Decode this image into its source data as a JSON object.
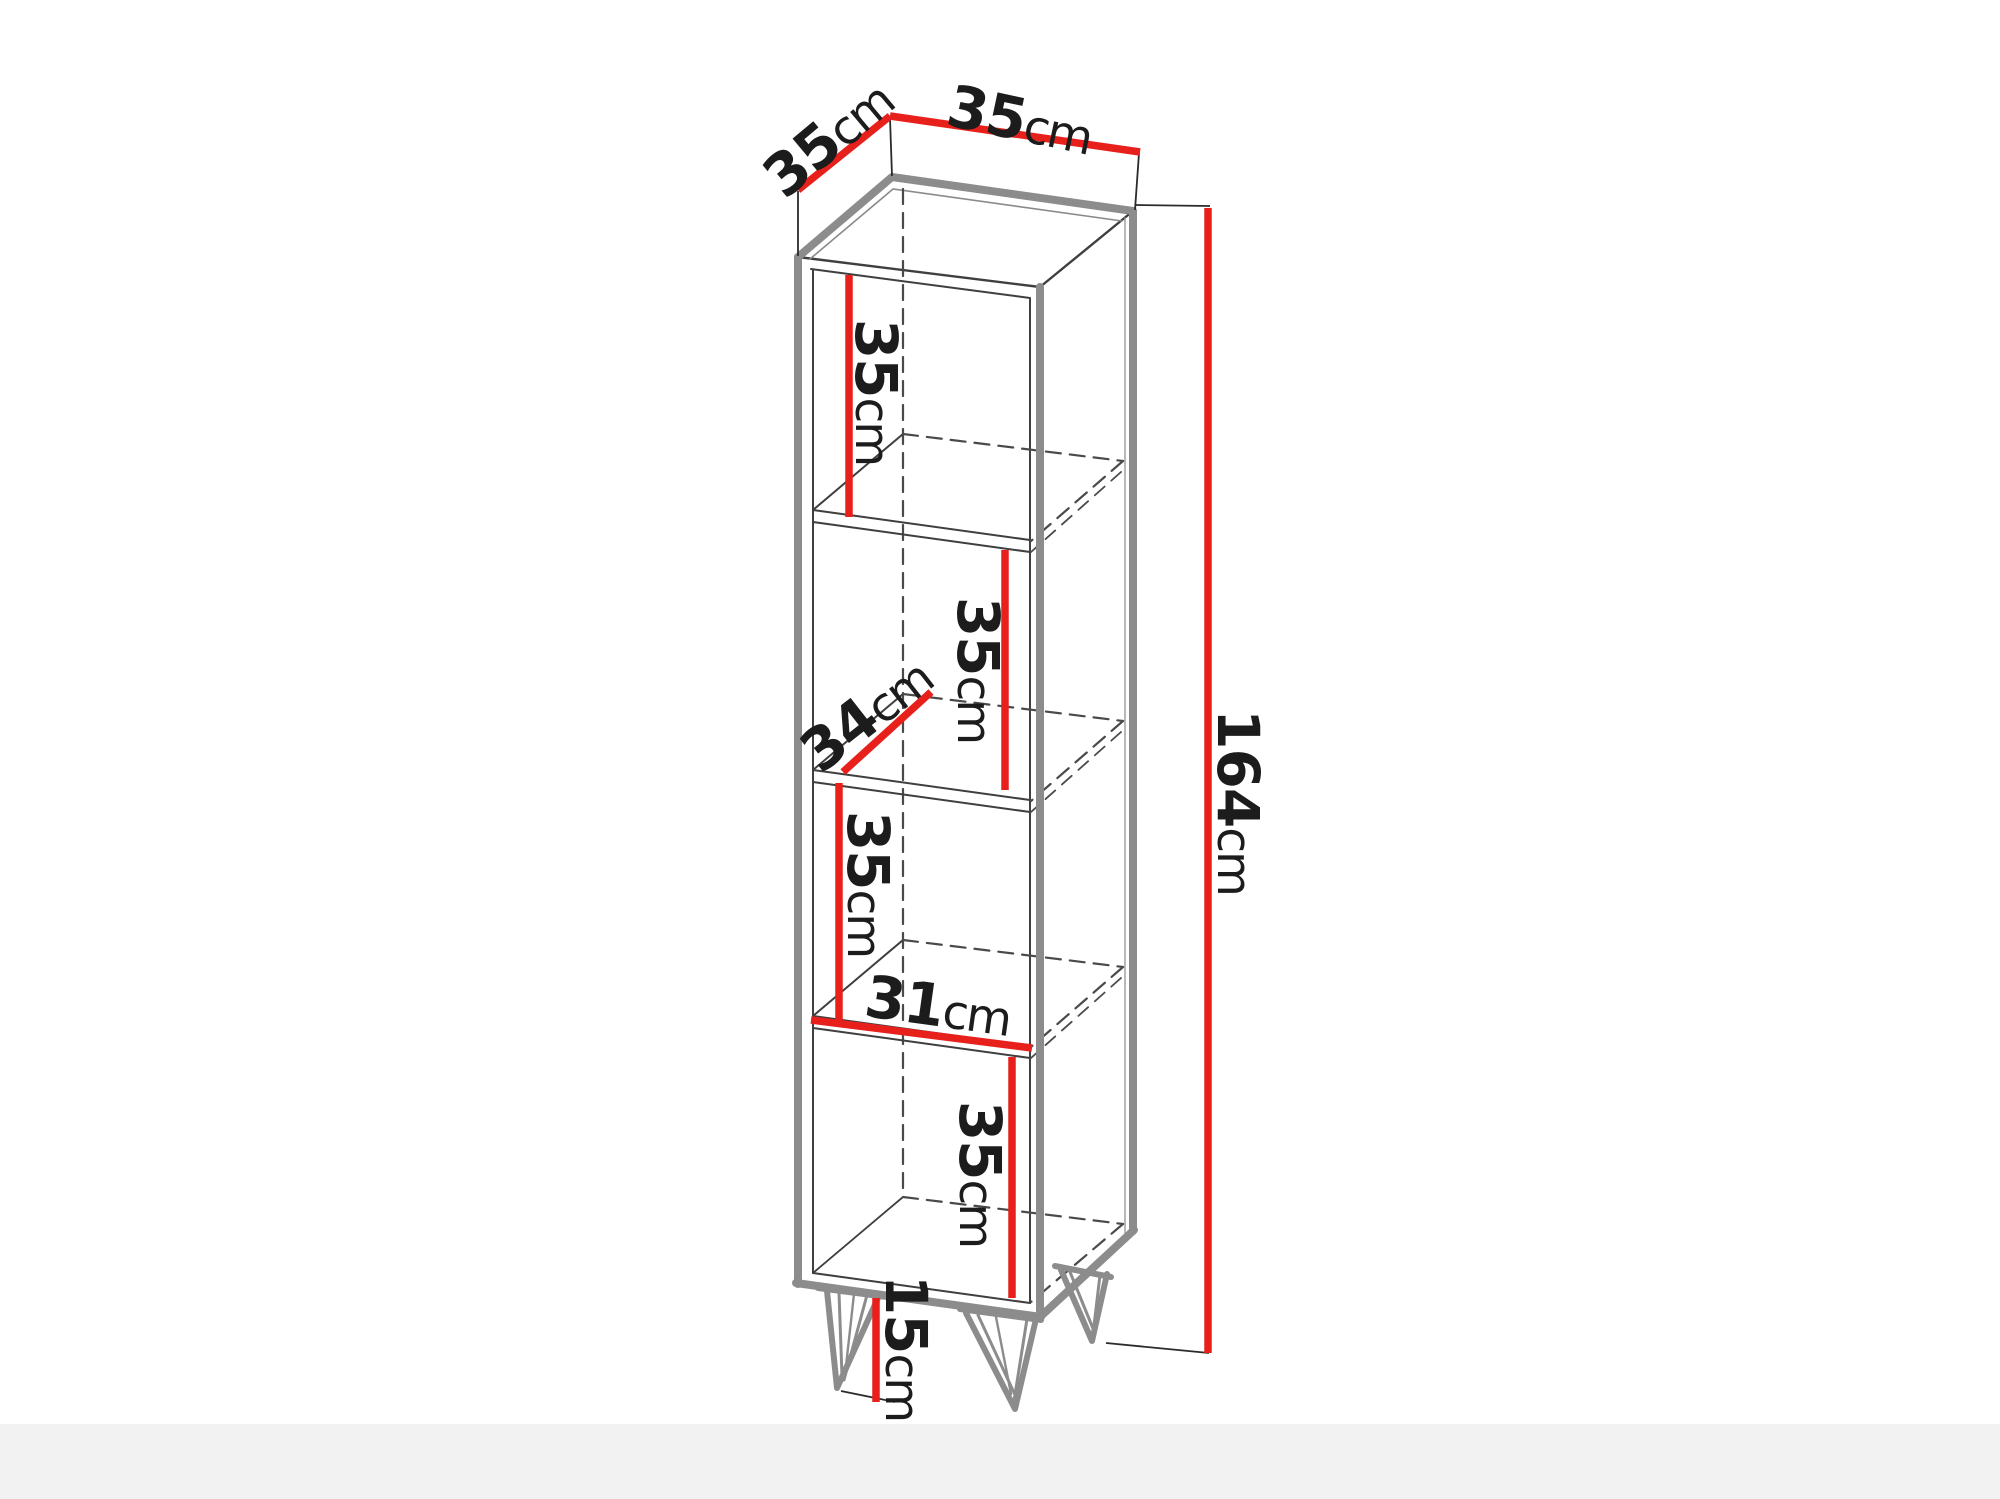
{
  "diagram": {
    "type": "furniture-dimension-drawing",
    "unit_system": "cm",
    "colors": {
      "dimension_line": "#e8201c",
      "outline_gray": "#8c8c8c",
      "line_dark": "#3f3f3f",
      "background": "#ffffff",
      "floor_band": "#f2f2f2"
    },
    "dimensions": {
      "top_depth": {
        "value": "35",
        "unit": "cm"
      },
      "top_width": {
        "value": "35",
        "unit": "cm"
      },
      "compartment_1": {
        "value": "35",
        "unit": "cm"
      },
      "compartment_2": {
        "value": "35",
        "unit": "cm"
      },
      "shelf_depth": {
        "value": "34",
        "unit": "cm"
      },
      "compartment_3": {
        "value": "35",
        "unit": "cm"
      },
      "shelf_width": {
        "value": "31",
        "unit": "cm"
      },
      "compartment_4": {
        "value": "35",
        "unit": "cm"
      },
      "leg_height": {
        "value": "15",
        "unit": "cm"
      },
      "total_height": {
        "value": "164",
        "unit": "cm"
      }
    }
  }
}
